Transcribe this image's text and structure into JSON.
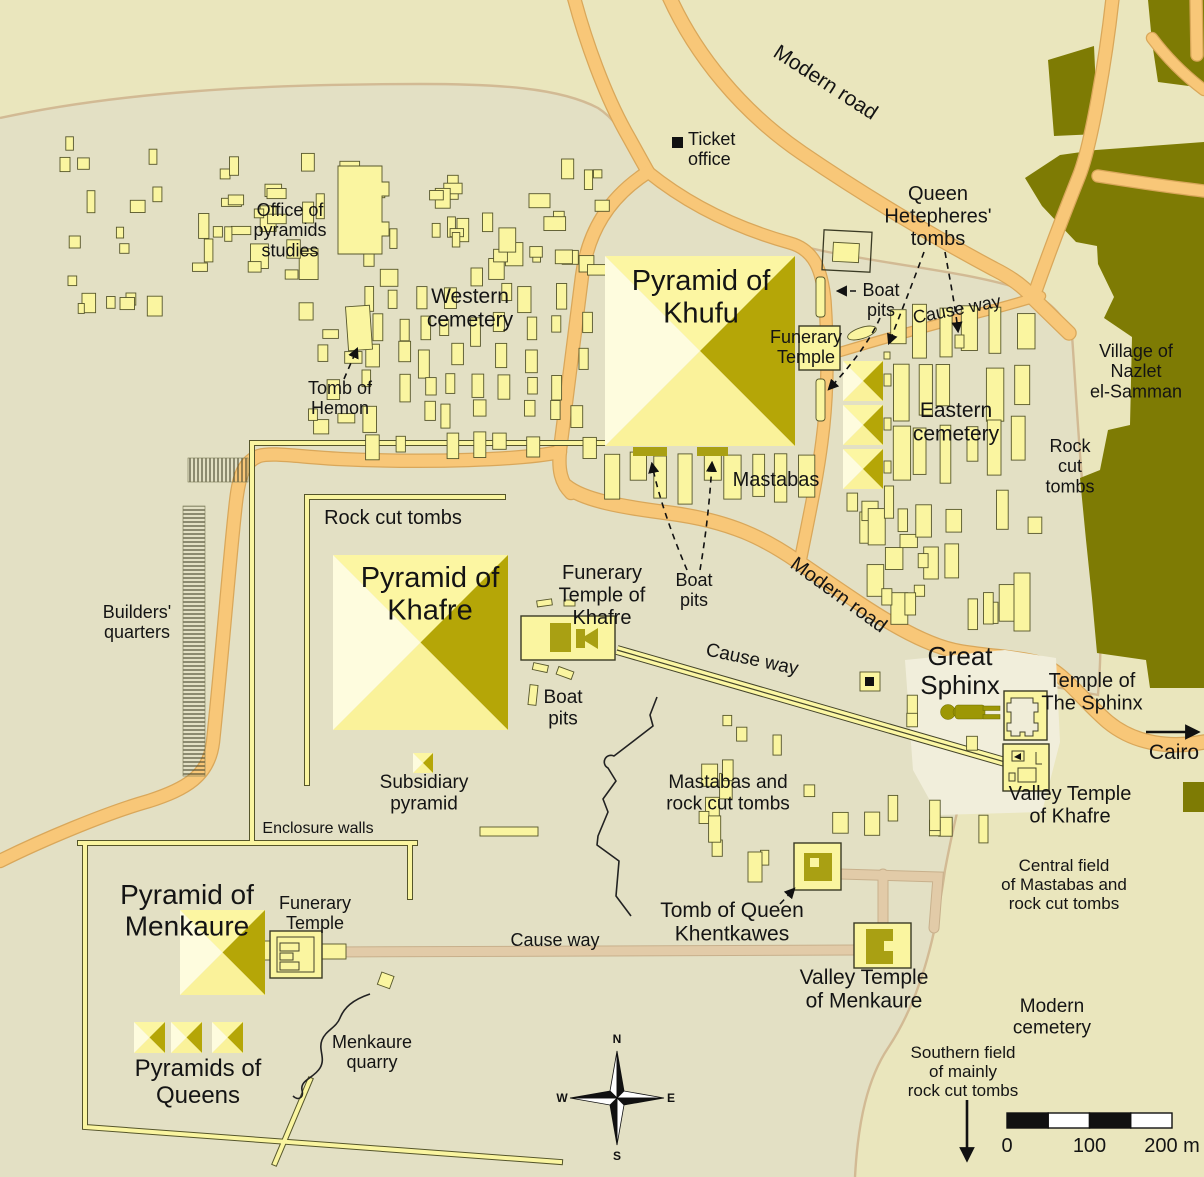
{
  "colors": {
    "background": "#EAE6BD",
    "plateau": "#E3E0C4",
    "sphinx_enclosure_bg": "#F1EEDB",
    "building_fill": "#FAF5A0",
    "building_stroke": "#56562B",
    "pyramid_faces": {
      "north": "#FCF6A2",
      "east": "#B5A607",
      "south": "#FAF29A",
      "west": "#FEFCDE"
    },
    "dark_structure": "#A9A013",
    "sphinx_body": "#9D9705",
    "village": "#7E7B04",
    "road_fill": "#F8C778",
    "road_edge": "#D9A75A",
    "tan_causeway": "#E2CBA8",
    "contour_line": "#D2BA94",
    "text": "#141414",
    "black": "#111111"
  },
  "labels": [
    {
      "id": "modern-road-top",
      "lines": [
        "Modern road"
      ],
      "x": 822,
      "y": 88,
      "size": 21,
      "rotate": 33
    },
    {
      "id": "ticket-office",
      "lines": [
        "Ticket",
        "office"
      ],
      "x": 688,
      "y": 145,
      "size": 18,
      "anchor": "start"
    },
    {
      "id": "queen-hetepheres-tombs",
      "lines": [
        "Queen",
        "Hetepheres'",
        "tombs"
      ],
      "x": 938,
      "y": 200,
      "size": 20
    },
    {
      "id": "office-of-pyramids-studies",
      "lines": [
        "Office of",
        "pyramids",
        "studies"
      ],
      "x": 290,
      "y": 216,
      "size": 18
    },
    {
      "id": "western-cemetery",
      "lines": [
        "Western",
        "cemetery"
      ],
      "x": 470,
      "y": 303,
      "size": 21
    },
    {
      "id": "pyramid-of-khufu",
      "lines": [
        "Pyramid of",
        "Khufu"
      ],
      "x": 701,
      "y": 290,
      "size": 29
    },
    {
      "id": "funerary-temple-khufu",
      "lines": [
        "Funerary",
        "Temple"
      ],
      "x": 806,
      "y": 343,
      "size": 18
    },
    {
      "id": "boat-pits-khufu-ne",
      "lines": [
        "Boat",
        "pits"
      ],
      "x": 881,
      "y": 296,
      "size": 18
    },
    {
      "id": "cause-way-khufu",
      "lines": [
        "Cause way"
      ],
      "x": 958,
      "y": 315,
      "size": 18,
      "rotate": -11
    },
    {
      "id": "village-nazlet-el-samman",
      "lines": [
        "Village of",
        "Nazlet",
        "el-Samman"
      ],
      "x": 1136,
      "y": 357,
      "size": 18
    },
    {
      "id": "eastern-cemetery",
      "lines": [
        "Eastern",
        "cemetery"
      ],
      "x": 956,
      "y": 417,
      "size": 21
    },
    {
      "id": "rock-cut-tombs-east",
      "lines": [
        "Rock",
        "cut",
        "tombs"
      ],
      "x": 1070,
      "y": 452,
      "size": 18
    },
    {
      "id": "tomb-of-hemon",
      "lines": [
        "Tomb of",
        "Hemon"
      ],
      "x": 340,
      "y": 394,
      "size": 18
    },
    {
      "id": "mastabas",
      "lines": [
        "Mastabas"
      ],
      "x": 776,
      "y": 486,
      "size": 20
    },
    {
      "id": "rock-cut-tombs-west",
      "lines": [
        "Rock cut tombs"
      ],
      "x": 393,
      "y": 524,
      "size": 20
    },
    {
      "id": "modern-road-mid",
      "lines": [
        "Modern road"
      ],
      "x": 835,
      "y": 600,
      "size": 20,
      "rotate": 36
    },
    {
      "id": "pyramid-of-khafre",
      "lines": [
        "Pyramid of",
        "Khafre"
      ],
      "x": 430,
      "y": 587,
      "size": 29
    },
    {
      "id": "funerary-temple-of-khafre",
      "lines": [
        "Funerary",
        "Temple of",
        "Khafre"
      ],
      "x": 602,
      "y": 579,
      "size": 20
    },
    {
      "id": "boat-pits-khufu-south",
      "lines": [
        "Boat",
        "pits"
      ],
      "x": 694,
      "y": 586,
      "size": 18
    },
    {
      "id": "builders-quarters",
      "lines": [
        "Builders'",
        "quarters"
      ],
      "x": 137,
      "y": 618,
      "size": 18
    },
    {
      "id": "cause-way-khafre",
      "lines": [
        "Cause way"
      ],
      "x": 751,
      "y": 665,
      "size": 19,
      "rotate": 12
    },
    {
      "id": "great-sphinx",
      "lines": [
        "Great",
        "Sphinx"
      ],
      "x": 960,
      "y": 665,
      "size": 26
    },
    {
      "id": "temple-of-the-sphinx",
      "lines": [
        "Temple of",
        "The Sphinx"
      ],
      "x": 1092,
      "y": 687,
      "size": 20
    },
    {
      "id": "boat-pits-khafre",
      "lines": [
        "Boat",
        "pits"
      ],
      "x": 563,
      "y": 703,
      "size": 19
    },
    {
      "id": "cairo",
      "lines": [
        "Cairo"
      ],
      "x": 1174,
      "y": 759,
      "size": 21
    },
    {
      "id": "subsidiary-pyramid",
      "lines": [
        "Subsidiary",
        "pyramid"
      ],
      "x": 424,
      "y": 788,
      "size": 19
    },
    {
      "id": "mastabas-and-rock-cut-tombs",
      "lines": [
        "Mastabas and",
        "rock cut tombs"
      ],
      "x": 728,
      "y": 788,
      "size": 19
    },
    {
      "id": "valley-temple-of-khafre",
      "lines": [
        "Valley Temple",
        "of Khafre"
      ],
      "x": 1070,
      "y": 800,
      "size": 20
    },
    {
      "id": "enclosure-walls",
      "lines": [
        "Enclosure walls"
      ],
      "x": 318,
      "y": 833,
      "size": 16
    },
    {
      "id": "central-field",
      "lines": [
        "Central field",
        "of Mastabas and",
        "rock cut tombs"
      ],
      "x": 1064,
      "y": 871,
      "size": 17
    },
    {
      "id": "pyramid-of-menkaure",
      "lines": [
        "Pyramid of",
        "Menkaure"
      ],
      "x": 187,
      "y": 904,
      "size": 28
    },
    {
      "id": "funerary-temple-menkaure",
      "lines": [
        "Funerary",
        "Temple"
      ],
      "x": 315,
      "y": 909,
      "size": 18
    },
    {
      "id": "tomb-of-queen-khentkawes",
      "lines": [
        "Tomb of Queen",
        "Khentkawes"
      ],
      "x": 732,
      "y": 917,
      "size": 21
    },
    {
      "id": "cause-way-menkaure",
      "lines": [
        "Cause way"
      ],
      "x": 555,
      "y": 946,
      "size": 18
    },
    {
      "id": "valley-temple-of-menkaure",
      "lines": [
        "Valley Temple",
        "of Menkaure"
      ],
      "x": 864,
      "y": 984,
      "size": 21
    },
    {
      "id": "modern-cemetery",
      "lines": [
        "Modern",
        "cemetery"
      ],
      "x": 1052,
      "y": 1012,
      "size": 19
    },
    {
      "id": "menkaure-quarry",
      "lines": [
        "Menkaure",
        "quarry"
      ],
      "x": 372,
      "y": 1048,
      "size": 18
    },
    {
      "id": "southern-field",
      "lines": [
        "Southern field",
        "of mainly",
        "rock cut tombs"
      ],
      "x": 963,
      "y": 1058,
      "size": 17
    },
    {
      "id": "pyramids-of-queens",
      "lines": [
        "Pyramids of",
        "Queens"
      ],
      "x": 198,
      "y": 1076,
      "size": 24
    }
  ],
  "compass": {
    "x": 617,
    "y": 1098,
    "letters": {
      "n": "N",
      "e": "E",
      "s": "S",
      "w": "W"
    }
  },
  "scale_bar": {
    "x": 1007,
    "y": 1113,
    "width": 165,
    "height": 15,
    "segments": 4,
    "tick_labels": [
      "0",
      "100",
      "200 m"
    ]
  },
  "geometry": {
    "pyramids": [
      {
        "name": "pyramid-of-khufu",
        "x": 605,
        "y": 256,
        "s": 190
      },
      {
        "name": "pyramid-of-khafre",
        "x": 333,
        "y": 555,
        "s": 175
      },
      {
        "name": "pyramid-of-menkaure",
        "x": 180,
        "y": 910,
        "s": 85
      },
      {
        "name": "queen-pyramid-khufu-1",
        "x": 843,
        "y": 361,
        "s": 40
      },
      {
        "name": "queen-pyramid-khufu-2",
        "x": 843,
        "y": 405,
        "s": 40
      },
      {
        "name": "queen-pyramid-khufu-3",
        "x": 843,
        "y": 449,
        "s": 40
      },
      {
        "name": "queen-pyramid-menkaure-1",
        "x": 134,
        "y": 1022,
        "s": 31
      },
      {
        "name": "queen-pyramid-menkaure-2",
        "x": 171,
        "y": 1022,
        "s": 31
      },
      {
        "name": "queen-pyramid-menkaure-3",
        "x": 212,
        "y": 1022,
        "s": 31
      },
      {
        "name": "subsidiary-pyramid",
        "x": 413,
        "y": 753,
        "s": 20
      }
    ],
    "fields": [
      {
        "name": "western-cemetery-grid",
        "type": "grid",
        "x": 368,
        "y": 288,
        "cols": 9,
        "rows": 6,
        "dx": 26,
        "dy": 29,
        "bw": 11,
        "bh": 22,
        "jx": 7,
        "jy": 5,
        "skip": 0.13,
        "seed": 11
      },
      {
        "name": "western-cemetery-north",
        "type": "scatter",
        "x0": 192,
        "y0": 152,
        "x1": 612,
        "y1": 288,
        "n": 58,
        "w0": 7,
        "w1": 22,
        "h0": 8,
        "h1": 26,
        "seed": 22
      },
      {
        "name": "western-cemetery-west",
        "type": "scatter",
        "x0": 52,
        "y0": 122,
        "x1": 192,
        "y1": 330,
        "n": 17,
        "w0": 6,
        "w1": 16,
        "h0": 8,
        "h1": 22,
        "seed": 33
      },
      {
        "name": "western-cemetery-south",
        "type": "scatter",
        "x0": 296,
        "y0": 300,
        "x1": 368,
        "y1": 440,
        "n": 9,
        "w0": 8,
        "w1": 18,
        "h0": 8,
        "h1": 20,
        "seed": 44
      },
      {
        "name": "eastern-cemetery-grid",
        "type": "grid",
        "x": 893,
        "y": 310,
        "cols": 6,
        "rows": 3,
        "dx": 24,
        "dy": 56,
        "bw": 14,
        "bh": 47,
        "jx": 5,
        "jy": 6,
        "skip": 0.12,
        "seed": 55
      },
      {
        "name": "eastern-cemetery-scatter",
        "type": "scatter",
        "x0": 845,
        "y0": 478,
        "x1": 1048,
        "y1": 632,
        "n": 24,
        "w0": 8,
        "w1": 18,
        "h0": 10,
        "h1": 40,
        "seed": 66
      },
      {
        "name": "khufu-mastaba-row",
        "type": "grid",
        "x": 606,
        "y": 454,
        "cols": 9,
        "rows": 1,
        "dx": 24,
        "dy": 0,
        "bw": 15,
        "bh": 40,
        "jx": 3,
        "jy": 3,
        "skip": 0,
        "seed": 77
      },
      {
        "name": "central-field-scatter",
        "type": "scatter",
        "x0": 690,
        "y0": 695,
        "x1": 1000,
        "y1": 868,
        "n": 22,
        "w0": 8,
        "w1": 16,
        "h0": 10,
        "h1": 34,
        "seed": 88
      }
    ]
  }
}
